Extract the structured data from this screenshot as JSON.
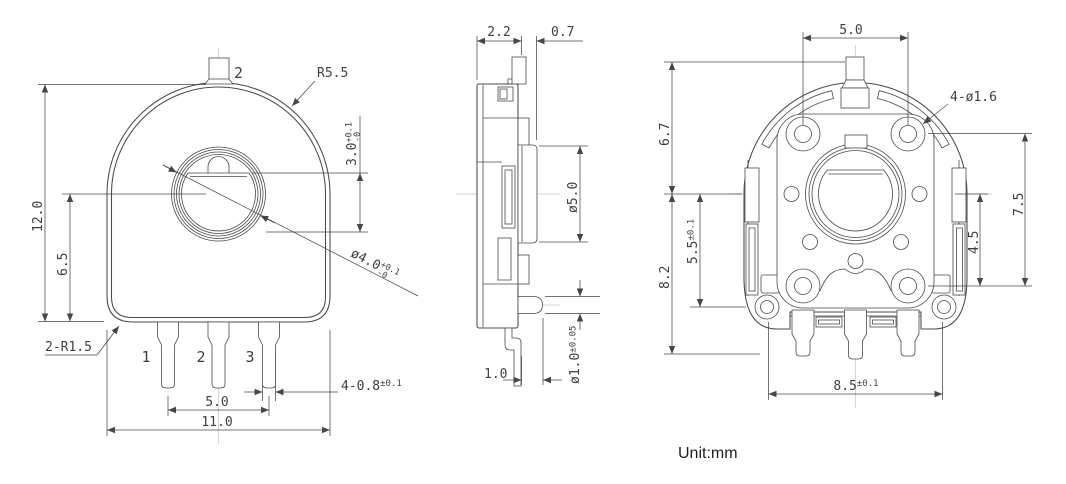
{
  "unit_label": "Unit:mm",
  "front": {
    "top_terminal": "2",
    "body_radius": "R5.5",
    "overall_height": "12.0",
    "center_height": "6.5",
    "slot": {
      "value": "3.0",
      "tol_plus": "+0.1",
      "tol_minus": "-0"
    },
    "shaft": {
      "value": "ø4.0",
      "tol_plus": "+0.1",
      "tol_minus": "-0"
    },
    "corner_radius": "2-R1.5",
    "terminals": [
      "1",
      "2",
      "3"
    ],
    "pin_width": {
      "value": "4-0.8",
      "tol": "±0.1"
    },
    "pin_pitch": "5.0",
    "overall_width": "11.0"
  },
  "side": {
    "body_thickness": "2.2",
    "bracket_offset": "0.7",
    "collar_dia": "ø5.0",
    "pin_dia": {
      "value": "ø1.0",
      "tol": "±0.05"
    },
    "pin_offset": "1.0"
  },
  "back": {
    "hole_pitch": "5.0",
    "mounting_holes": "4-ø1.6",
    "upper_height": "6.7",
    "lower_height": "8.2",
    "cover_height": {
      "value": "5.5",
      "tol": "±0.1"
    },
    "hole_span": "7.5",
    "hole_offset": "4.5",
    "tab_pitch": {
      "value": "8.5",
      "tol": "±0.1"
    }
  }
}
